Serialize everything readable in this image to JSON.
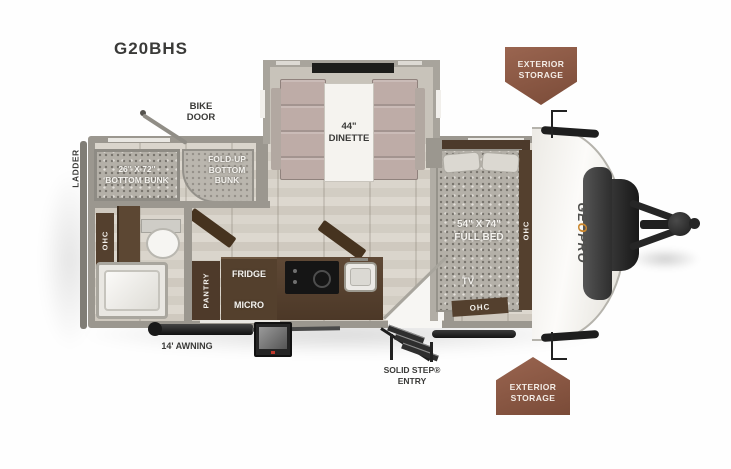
{
  "model": "G20BHS",
  "colors": {
    "text": "#3a3a38",
    "wall": "#9b978f",
    "cabinet": "#54402e",
    "badge": "#8a5744",
    "brand_orange": "#c9862e",
    "floor": "#d7d3ca"
  },
  "exterior": {
    "ladder": "LADDER",
    "bike_door": "BIKE\nDOOR",
    "awning": "14' AWNING",
    "entry": "SOLID STEP®\nENTRY",
    "storage_top": "EXTERIOR\nSTORAGE",
    "storage_bottom": "EXTERIOR\nSTORAGE",
    "brand_ge": "GE",
    "brand_o": "O",
    "brand_pro": "PRO"
  },
  "rooms": {
    "dinette": "44\"\nDINETTE",
    "bottom_bunk": "26\" X 72\"\nBOTTOM BUNK",
    "fold_up_bunk": "FOLD-UP\nBOTTOM\nBUNK",
    "full_bed": "54\" X 74\"\nFULL BED",
    "tv": "TV",
    "pantry": "PANTRY",
    "fridge": "FRIDGE",
    "micro": "MICRO",
    "ohc_bath": "OHC",
    "ohc_bed_side": "OHC",
    "ohc_bed_foot": "OHC"
  }
}
